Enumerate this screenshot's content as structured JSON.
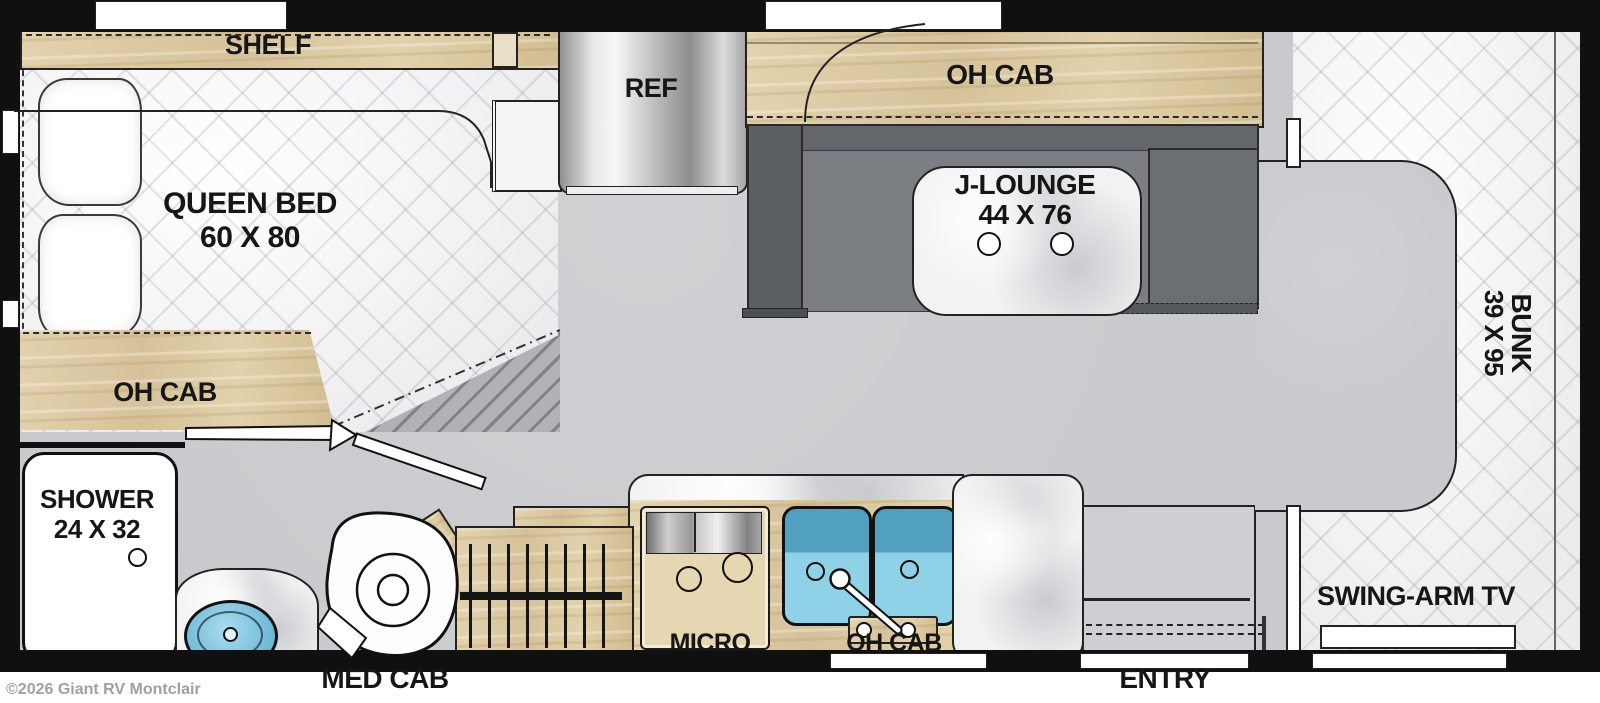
{
  "labels": {
    "shelf": "SHELF",
    "queen_bed_name": "QUEEN BED",
    "queen_bed_size": "60 X 80",
    "bedroom_oh_cab": "OH CAB",
    "ref": "REF",
    "galley_oh_cab": "OH CAB",
    "j_lounge_name": "J-LOUNGE",
    "j_lounge_size": "44 X 76",
    "bunk_name": "BUNK",
    "bunk_size": "39 X 95",
    "shower_name": "SHOWER",
    "shower_size": "24 X 32",
    "med_cab": "MED CAB",
    "micro": "MICRO",
    "sink_oh_cab": "OH CAB",
    "entry": "ENTRY",
    "swing_arm_tv": "SWING-ARM TV",
    "copyright": "©2026 Giant RV Montclair"
  },
  "colors": {
    "wall": "#101010",
    "floor": "#c8cacd",
    "wood": "#dcc9a4",
    "couch": "#63666a",
    "sink_blue": "#7ec6de",
    "mattress": "#f7f7f8"
  }
}
